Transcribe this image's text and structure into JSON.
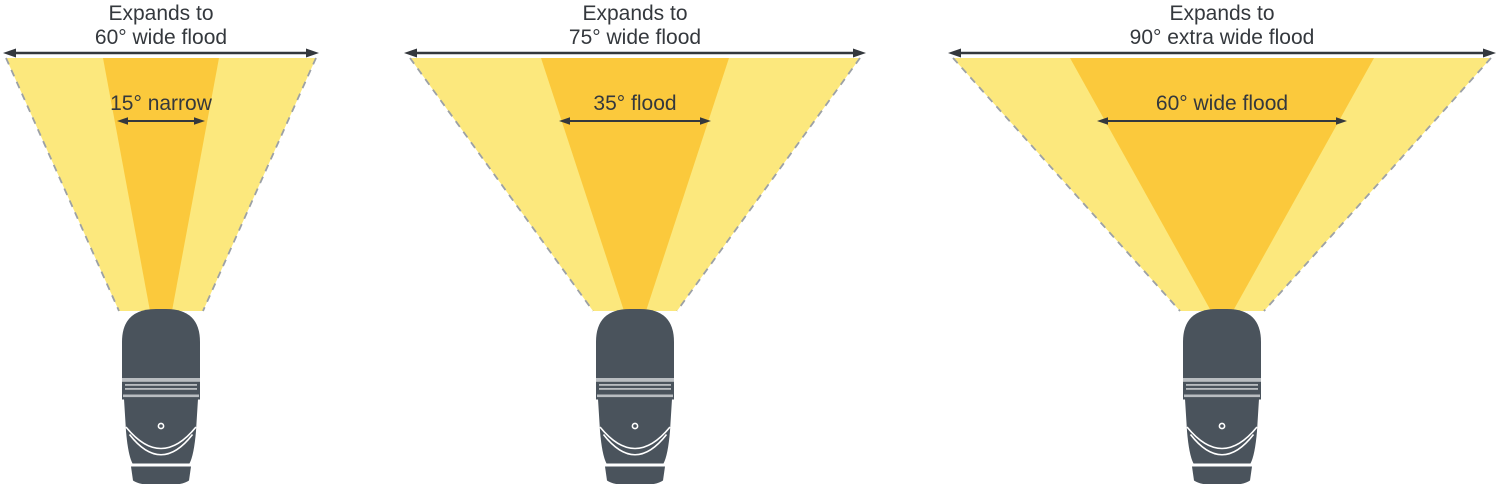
{
  "figure": {
    "description_labels_only": "Flashlight beam spread comparison diagram",
    "background": "#ffffff"
  },
  "colors": {
    "beam_outer": "#FCE87D",
    "beam_inner": "#FBC93C",
    "flashlight_body": "#4A535C",
    "flashlight_ring": "#B9BDC1",
    "dashed_edge": "#9CA1A6",
    "arrow_text": "#34383D"
  },
  "diagrams": [
    {
      "title_line1": "Expands to",
      "title_line2": "60° wide flood",
      "beam_label": "15° narrow"
    },
    {
      "title_line1": "Expands to",
      "title_line2": "75° wide flood",
      "beam_label": "35° flood"
    },
    {
      "title_line1": "Expands to",
      "title_line2": "90° extra wide flood",
      "beam_label": "60° wide flood"
    }
  ]
}
